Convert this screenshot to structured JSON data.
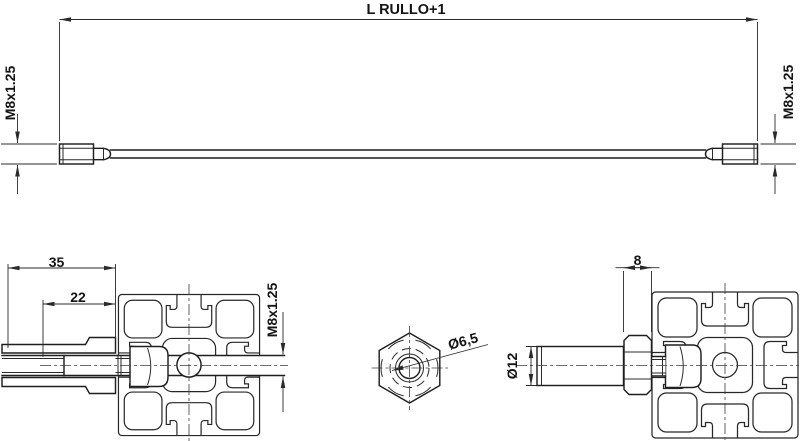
{
  "colors": {
    "background": "#ffffff",
    "line": "#1f1f1f",
    "dimension_line": "#2b2b2b",
    "text": "#141414"
  },
  "views": {
    "rod_side": {
      "length_dim": "L RULLO+1",
      "thread_dim_left": "M8x1.25",
      "thread_dim_right": "M8x1.25"
    },
    "left_section": {
      "overall_dim": "35",
      "engagement_dim": "22",
      "thread_dim": "M8x1.25"
    },
    "nut_face": {
      "bore_dim": "Ø6,5"
    },
    "right_mount": {
      "nut_width_dim": "8",
      "pin_dia_dim": "Ø12"
    }
  }
}
